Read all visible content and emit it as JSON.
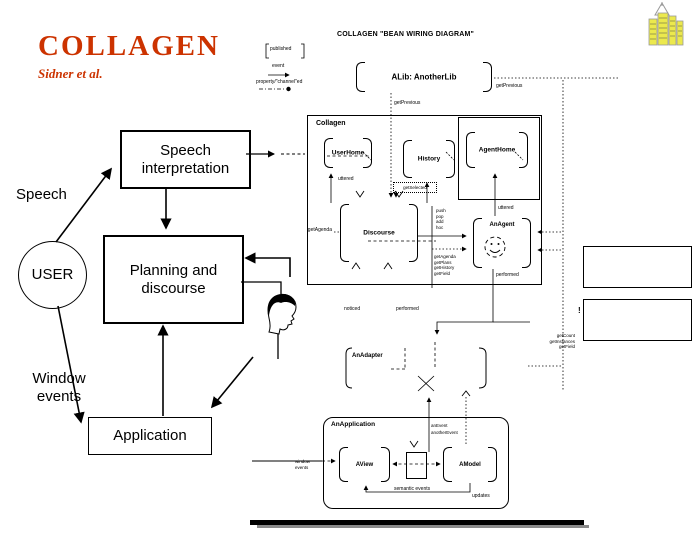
{
  "header": {
    "title": "COLLAGEN",
    "subtitle": "Sidner et al.",
    "accent_color": "#cc3300"
  },
  "logo": {
    "yellow": "#ece94d",
    "gray": "#999999"
  },
  "flow": {
    "speech_interpretation": "Speech interpretation",
    "planning_discourse": "Planning and discourse",
    "application": "Application",
    "user": "USER",
    "speech": "Speech",
    "window_events": "Window events"
  },
  "bean": {
    "title": "COLLAGEN \"BEAN WIRING DIAGRAM\"",
    "legend": {
      "published": "published",
      "event": "event",
      "property": "property/\"channel\"ed"
    },
    "alib": "ALib: AnotherLib",
    "get_previous_top": "getPrevious",
    "get_previous_mid": "getPrevious",
    "collagen": "Collagen",
    "user_home": "UserHome",
    "history": "History",
    "agent_home": "AgentHome",
    "uttered_user": "uttered",
    "get_selected": "getSelected",
    "discourse": "Discourse",
    "get_agenda": "getAgenda",
    "push_methods": [
      "push",
      "pop",
      "add",
      "hoc"
    ],
    "get_methods": [
      "getAgenda",
      "getPlans",
      "getHistory",
      "getField"
    ],
    "an_agent": "AnAgent",
    "uttered_agent": "uttered",
    "performed_agent": "performed",
    "noticed": "noticed",
    "performed": "performed",
    "an_adapter": "AnAdapter",
    "an_event": "anEvent",
    "another_event": "anotherEvent",
    "an_application": "AnApplication",
    "a_view": "AView",
    "a_model": "AModel",
    "window_events": "window events",
    "semantic_events": "semantic events",
    "updates": "updates",
    "exclamation": "!",
    "right_methods": [
      "getCount",
      "getInstances",
      "getField"
    ]
  }
}
